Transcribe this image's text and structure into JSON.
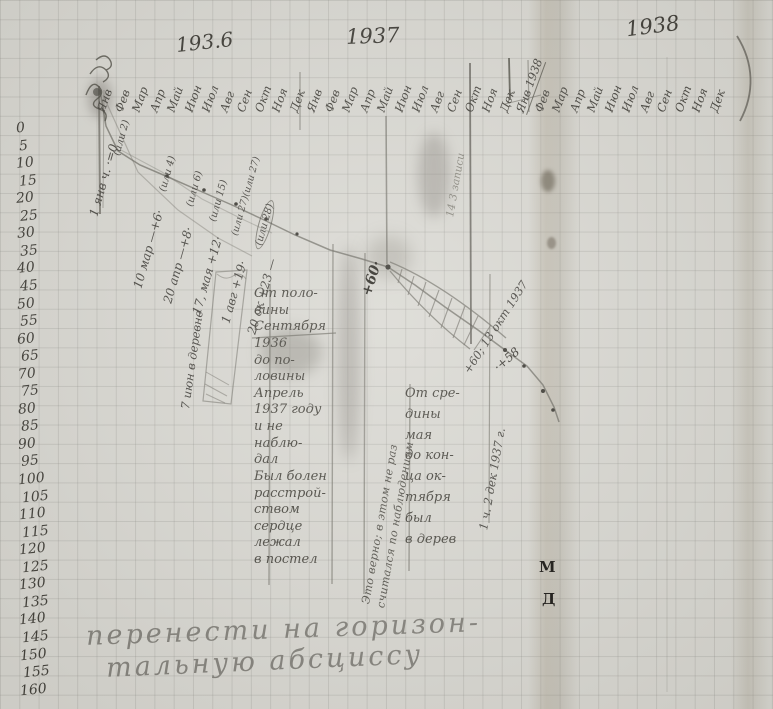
{
  "years": {
    "y1936": "193.6",
    "y1937": "1937",
    "y1938": "1938"
  },
  "months": {
    "y1936": [
      "Янв",
      "Фев",
      "Мар",
      "Апр",
      "Май",
      "Июн",
      "Июл",
      "Авг",
      "Сен",
      "Окт",
      "Ноя",
      "Дек"
    ],
    "y1937": [
      "Янв",
      "Фев",
      "Мар",
      "Апр",
      "Май",
      "Июн",
      "Июл",
      "Авг",
      "Сен",
      "Окт",
      "Ноя",
      "Дек"
    ],
    "y1938": [
      "Янв 1938",
      "Фев",
      "Мар",
      "Апр",
      "Май",
      "Июн",
      "Июл",
      "Авг",
      "Сен",
      "Окт",
      "Ноя",
      "Дек"
    ]
  },
  "axis": {
    "ticks": [
      "0",
      "5",
      "10",
      "15",
      "20",
      "25",
      "30",
      "35",
      "40",
      "45",
      "50",
      "55",
      "60",
      "65",
      "70",
      "75",
      "80",
      "85",
      "90",
      "95",
      "100",
      "105",
      "110",
      "115",
      "120",
      "125",
      "130",
      "135",
      "140",
      "145",
      "150",
      "155",
      "160"
    ]
  },
  "annotations": [
    "1 янв ч. ·=0",
    "(или 2)",
    "10 мар —+6·",
    "(или 4)",
    "20 апр —+8·",
    "(или 6)",
    "17, мая +12·",
    "(или 15)",
    "1 авг +19·",
    "(или 27)(или 27)",
    "20 ок +23 —",
    "(или 28)",
    "7 июн в деревне",
    "+60·",
    "14 3 записи",
    "+60; 13 окт 1937",
    "·+58",
    "1 ч. 2 дек 1937 г."
  ],
  "notes": {
    "center": "От поло-\nвины\nСентября\n1936\nдо по-\nловины\nАпрель\n1937 году\nи не\nнаблю-\nдал\nБыл болен\nрасстрой-\nством\nсердце\nлежал\nв постел",
    "right": "От сре-\nдины\nмая\nдо кон-\nца ок-\nтября\nбыл\nв дерев",
    "side1": "Это верно; в этом не раз",
    "side2": "считался по наблюдениям",
    "bottom1": "перенести на горизон-",
    "bottom2": "тальную абсциссу",
    "mark1": "М",
    "mark2": "Д"
  },
  "chart_data": {
    "type": "line",
    "x_years": [
      "1936",
      "1937",
      "1938"
    ],
    "x_months": [
      "Янв",
      "Фев",
      "Мар",
      "Апр",
      "Май",
      "Июн",
      "Июл",
      "Авг",
      "Сен",
      "Окт",
      "Ноя",
      "Дек"
    ],
    "y_axis": {
      "range": [
        0,
        160
      ],
      "step": 5,
      "inverted": true
    },
    "points": [
      {
        "date": "1 янв 1936",
        "value": 0,
        "alt": 2
      },
      {
        "date": "10 мар 1936",
        "value": 6,
        "alt": 4
      },
      {
        "date": "20 апр 1936",
        "value": 8,
        "alt": 6
      },
      {
        "date": "17 мая 1936",
        "value": 12,
        "alt": 15
      },
      {
        "date": "1 авг 1936",
        "value": 19,
        "alt": 27
      },
      {
        "date": "20 окт 1936",
        "value": 23,
        "alt": 28
      },
      {
        "date": "13 окт 1937",
        "value": 60
      },
      {
        "date": "2 дек 1937",
        "value": 58
      }
    ]
  }
}
